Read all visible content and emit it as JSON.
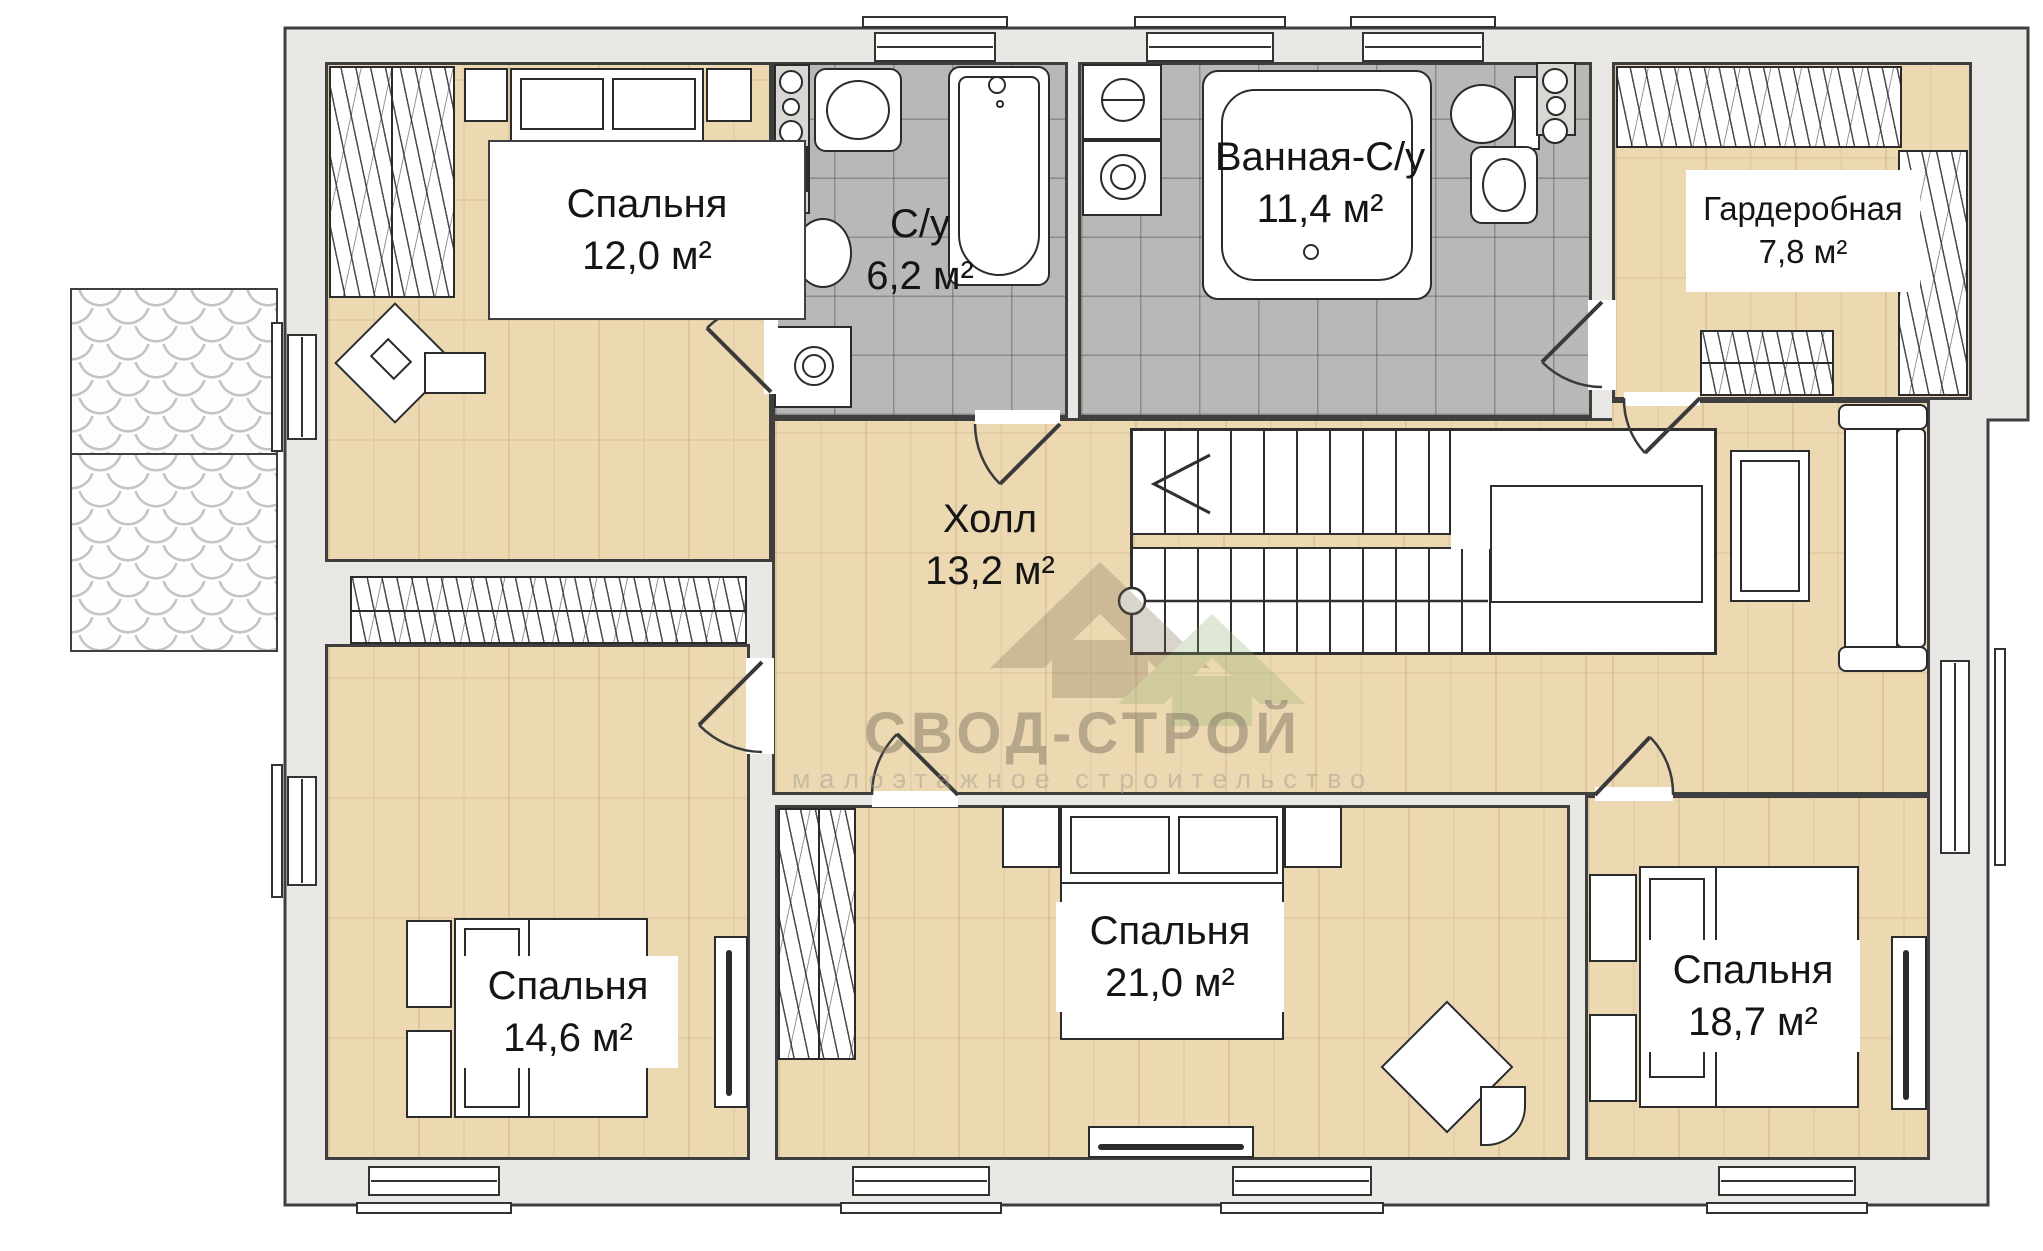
{
  "plan": {
    "watermark": {
      "title": "СВОД-СТРОЙ",
      "subtitle": "малоэтажное строительство"
    },
    "rooms": [
      {
        "name": "Спальня",
        "area": "12,0 м²"
      },
      {
        "name": "С/у",
        "area": "6,2 м²"
      },
      {
        "name": "Ванная-С/у",
        "area": "11,4 м²"
      },
      {
        "name": "Гардеробная",
        "area": "7,8 м²"
      },
      {
        "name": "Холл",
        "area": "13,2 м²"
      },
      {
        "name": "Спальня",
        "area": "14,6 м²"
      },
      {
        "name": "Спальня",
        "area": "21,0 м²"
      },
      {
        "name": "Спальня",
        "area": "18,7 м²"
      }
    ],
    "colors": {
      "wood": "#ecd9b2",
      "tile": "#b9b8b6",
      "wall": "#e9e8e5",
      "outline": "#3f3f3f"
    }
  }
}
